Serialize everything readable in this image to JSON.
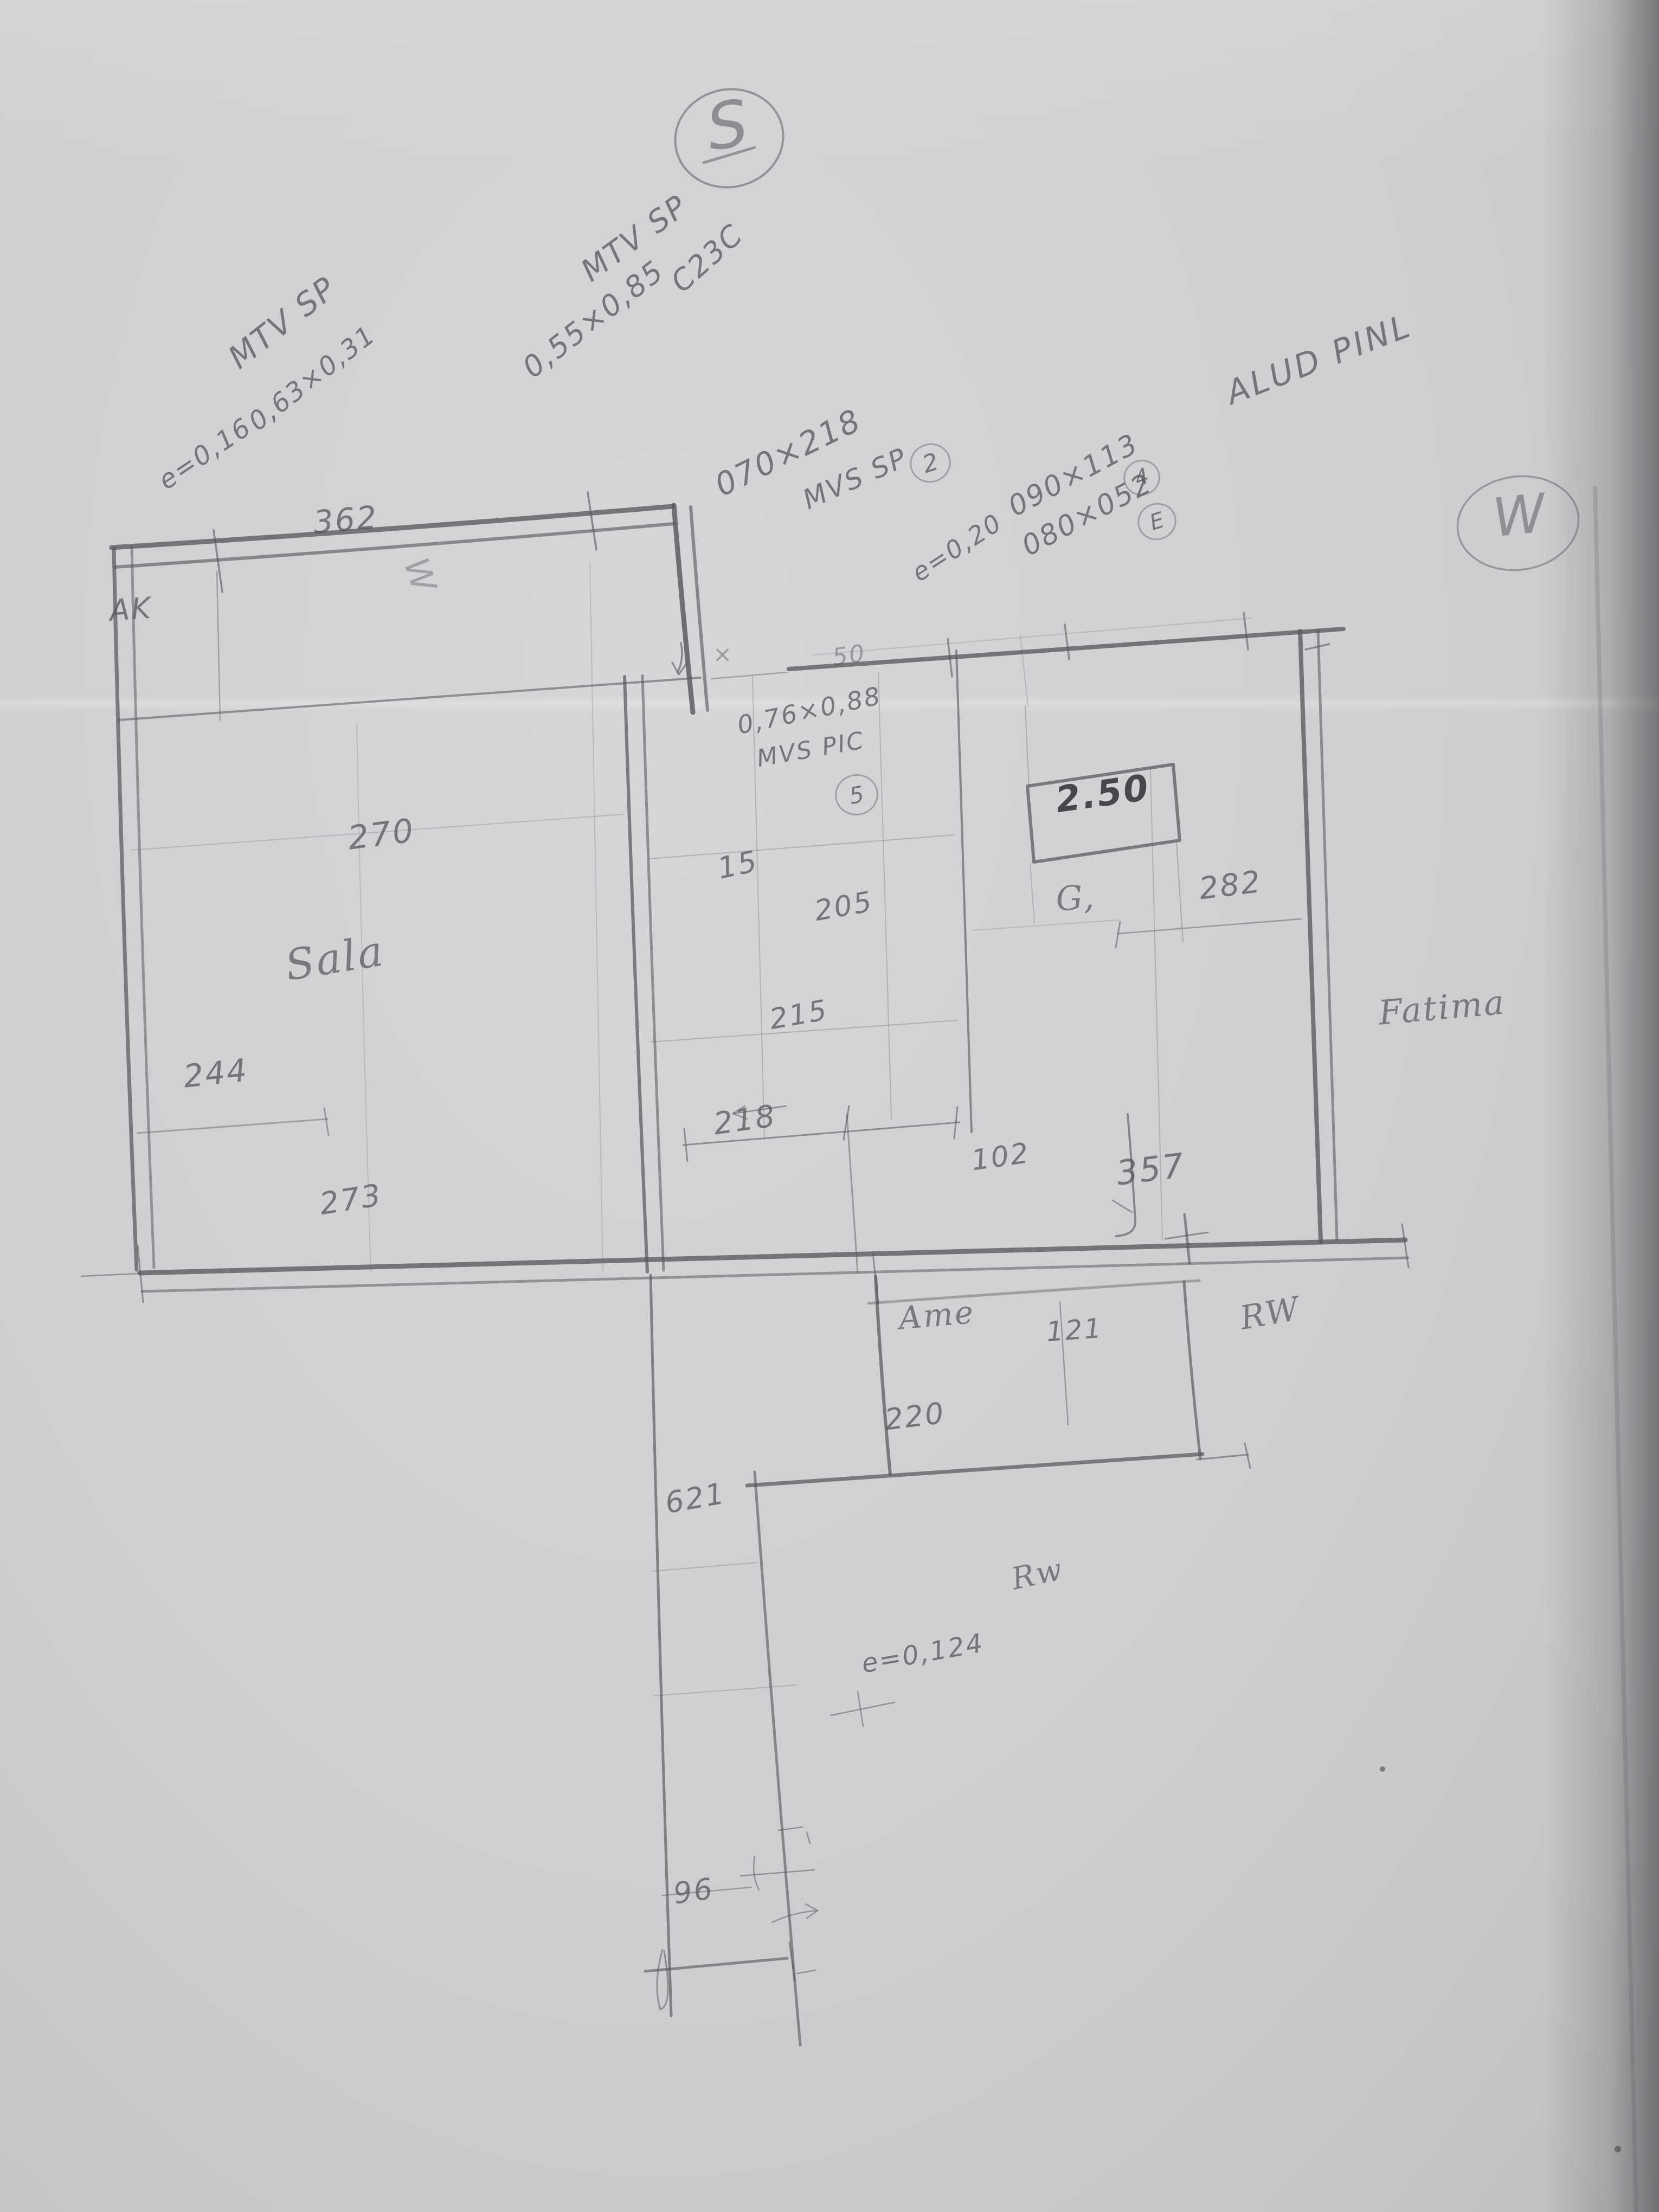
{
  "scene": {
    "description": "Hand-drawn pencil floor plan sketch photographed on gray paper"
  },
  "compass": {
    "south": "S",
    "west": "W"
  },
  "annotations": {
    "window1": {
      "name": "MTV SP",
      "thickness": "e=0,16",
      "size": "0,63×0,31"
    },
    "window2": {
      "name": "MTV SP",
      "size": "0,55×0,85",
      "code": "C23C"
    },
    "door1": {
      "size": "070×218",
      "name": "MVS SP",
      "ref": "2"
    },
    "wall_note1": "e=0,20",
    "window3": {
      "size": "090×113",
      "ref": "4"
    },
    "window4": {
      "size": "080×052",
      "ref": "E"
    },
    "material": "ALUD PINL",
    "window5": {
      "size": "0,76×0,88",
      "name": "MVS PIC",
      "ref": "5"
    },
    "wall_note2": "e=0,124",
    "height_boxed": "2.50"
  },
  "rooms": {
    "sala": "Sala",
    "ame": "Ame",
    "ak": "AK",
    "fatima": "Fatima",
    "rw_upper": "RW",
    "rw_lower": "Rw",
    "g_mark": "G,"
  },
  "dimensions": {
    "d362": "362",
    "d270": "270",
    "d244": "244",
    "d273": "273",
    "d15": "15",
    "d205": "205",
    "d215": "215",
    "d218": "218",
    "d102": "102",
    "d282": "282",
    "d357": "357",
    "d220": "220",
    "d121": "121",
    "d621": "621",
    "d96": "96"
  },
  "marks": {
    "x": "×",
    "fifty": "50",
    "w_scribble": "W"
  }
}
